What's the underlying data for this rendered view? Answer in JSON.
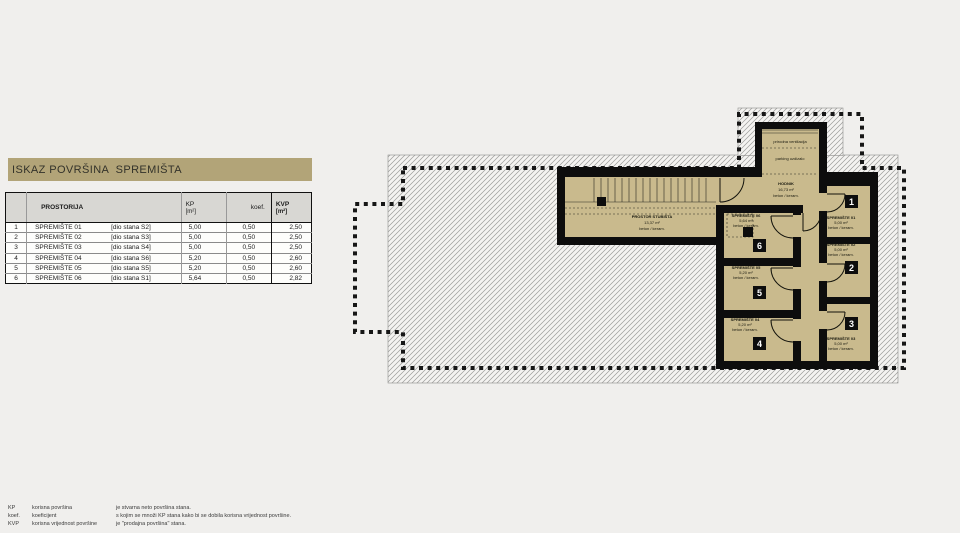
{
  "title_bar": {
    "text": "ISKAZ POVRŠINA  SPREMIŠTA"
  },
  "table": {
    "headers": {
      "prostorija": "PROSTORIJA",
      "kp": "KP",
      "kp_unit": "[m²]",
      "koef": "koef.",
      "kvp": "KVP",
      "kvp_unit": "[m²]"
    },
    "rows": [
      {
        "num": "1",
        "name": "SPREMIŠTE 01",
        "dio": "[dio stana S2]",
        "kp": "5,00",
        "koef": "0,50",
        "kvp": "2,50"
      },
      {
        "num": "2",
        "name": "SPREMIŠTE 02",
        "dio": "[dio stana S3]",
        "kp": "5,00",
        "koef": "0,50",
        "kvp": "2,50"
      },
      {
        "num": "3",
        "name": "SPREMIŠTE 03",
        "dio": "[dio stana S4]",
        "kp": "5,00",
        "koef": "0,50",
        "kvp": "2,50"
      },
      {
        "num": "4",
        "name": "SPREMIŠTE 04",
        "dio": "[dio stana S6]",
        "kp": "5,20",
        "koef": "0,50",
        "kvp": "2,60"
      },
      {
        "num": "5",
        "name": "SPREMIŠTE 05",
        "dio": "[dio stana S5]",
        "kp": "5,20",
        "koef": "0,50",
        "kvp": "2,60"
      },
      {
        "num": "6",
        "name": "SPREMIŠTE 06",
        "dio": "[dio stana S1]",
        "kp": "5,64",
        "koef": "0,50",
        "kvp": "2,82"
      }
    ]
  },
  "legend": {
    "rows": [
      {
        "term": "KP",
        "label": "korisna površina",
        "desc": "je stvarna neto površina stana."
      },
      {
        "term": "koef.",
        "label": "koeficijent",
        "desc": "s kojim se množi KP stana kako bi se dobila korisna vrijednost površine."
      },
      {
        "term": "KVP",
        "label": "korisna vrijednost površine",
        "desc": "je \"prodajna površina\" stana."
      }
    ]
  },
  "plan": {
    "colors": {
      "room_fill": "#c9ba8d",
      "wall": "#0d0d0d",
      "hatch_line": "#9b9b99"
    },
    "stairwell": {
      "name": "PROSTOR STUBIŠTA",
      "area": "13,37 m²",
      "finish": "beton / keram."
    },
    "hodnik": {
      "name": "HODNIK",
      "area": "16,73 m²",
      "finish": "beton / keram."
    },
    "shaft": {
      "line1": "prirodna ventilacija",
      "line2": "parking uzdizalo"
    },
    "rooms": [
      {
        "number": "1",
        "name": "SPREMIŠTE 01",
        "area": "5,00 m²",
        "finish": "beton / keram."
      },
      {
        "number": "2",
        "name": "SPREMIŠTE 02",
        "area": "5,00 m²",
        "finish": "beton / keram."
      },
      {
        "number": "3",
        "name": "SPREMIŠTE 03",
        "area": "5,00 m²",
        "finish": "beton / keram."
      },
      {
        "number": "4",
        "name": "SPREMIŠTE 04",
        "area": "5,20 m²",
        "finish": "beton / keram."
      },
      {
        "number": "5",
        "name": "SPREMIŠTE 05",
        "area": "5,20 m²",
        "finish": "beton / keram."
      },
      {
        "number": "6",
        "name": "SPREMIŠTE 06",
        "area": "5,64 m²",
        "finish": "beton / keram."
      }
    ]
  }
}
